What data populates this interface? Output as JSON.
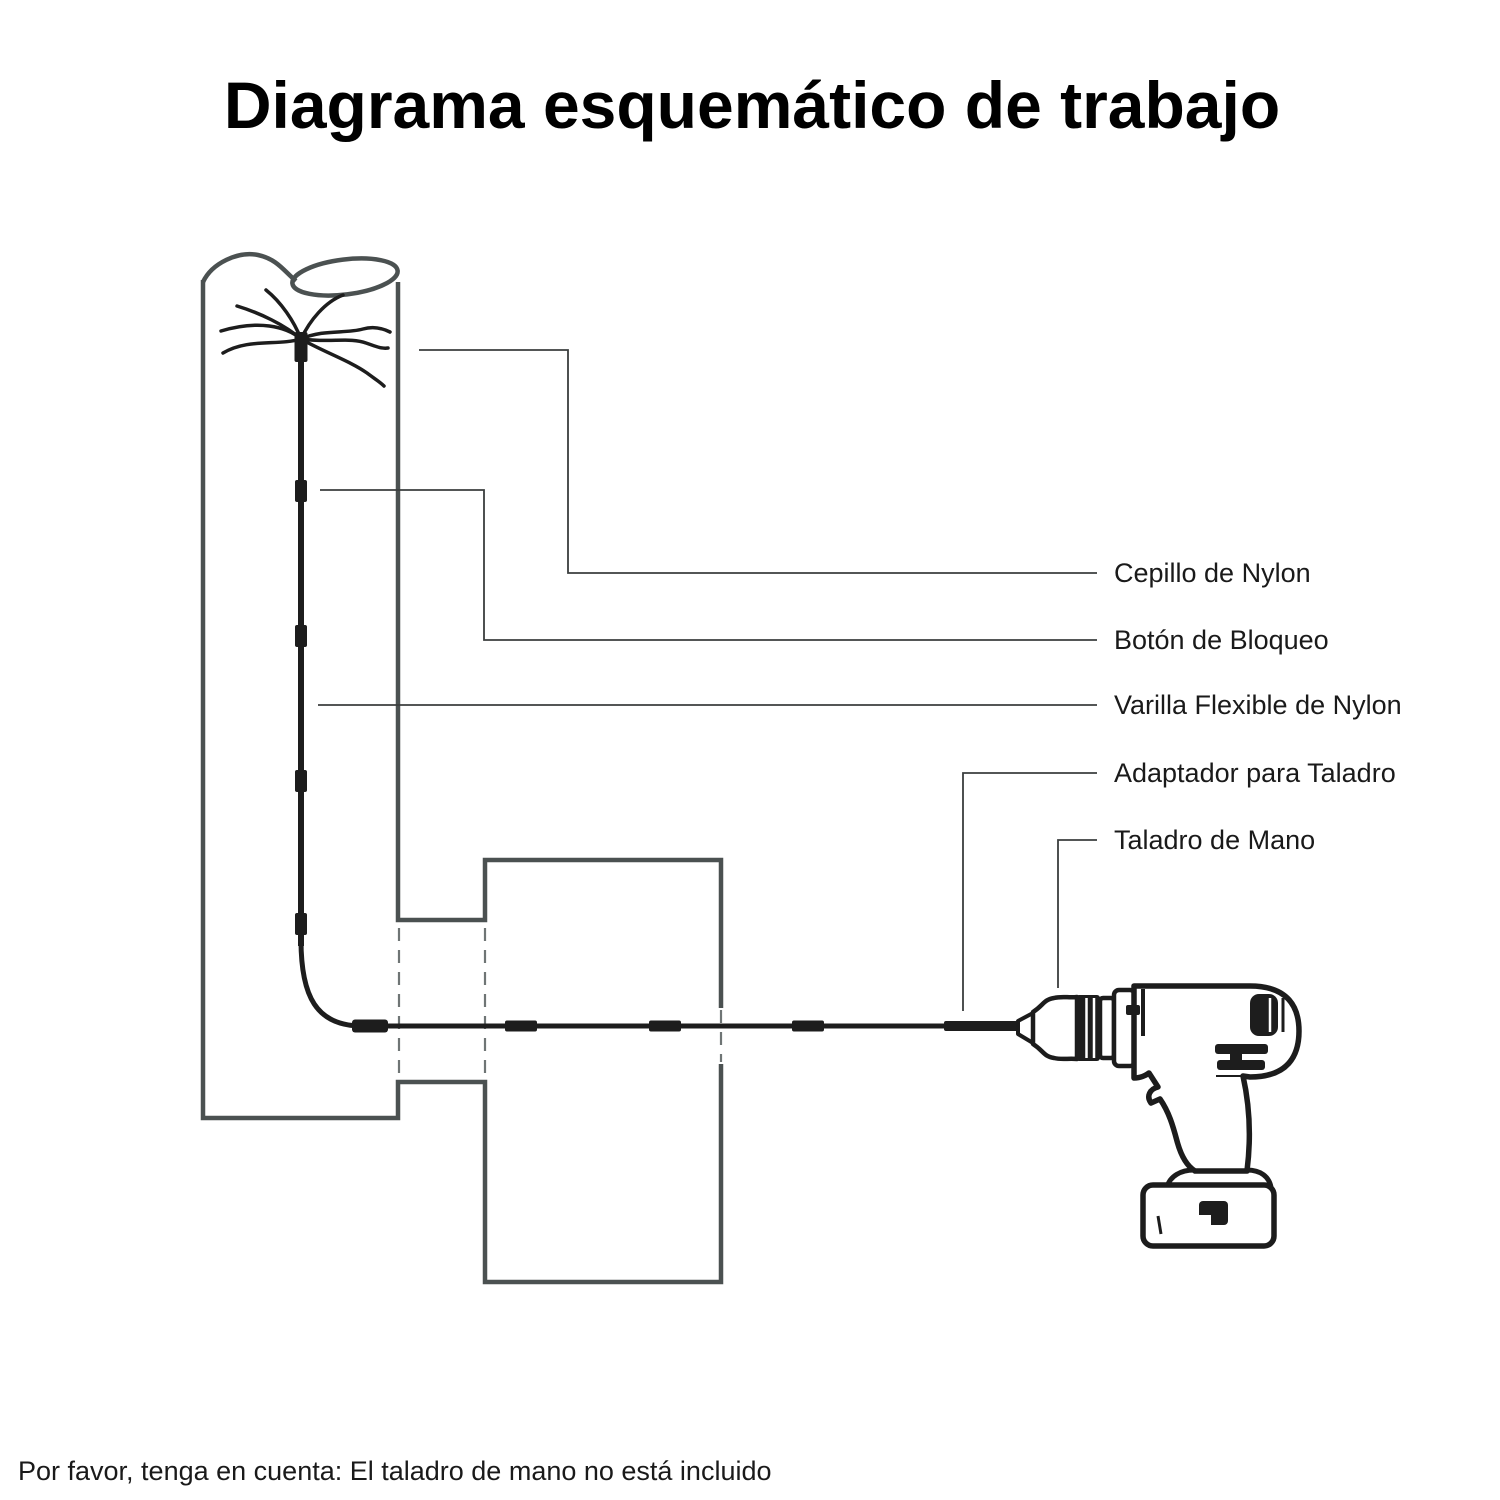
{
  "title": "Diagrama esquemático de trabajo",
  "note": "Por favor, tenga en cuenta: El taladro de mano no está incluido",
  "diagram": {
    "labels": [
      {
        "id": "nylon-brush",
        "text": "Cepillo de Nylon"
      },
      {
        "id": "lock-button",
        "text": "Botón de Bloqueo"
      },
      {
        "id": "flexible-nylon-rod",
        "text": "Varilla Flexible de Nylon"
      },
      {
        "id": "drill-adapter",
        "text": "Adaptador para Taladro"
      },
      {
        "id": "hand-drill",
        "text": "Taladro de Mano"
      }
    ],
    "colors": {
      "wall": "#4b5151",
      "hidden_edge": "#6f7575",
      "leader": "#3b3e3e",
      "rod": "#1d1d1d",
      "text": "#1a1a1a",
      "background": "#ffffff"
    }
  }
}
